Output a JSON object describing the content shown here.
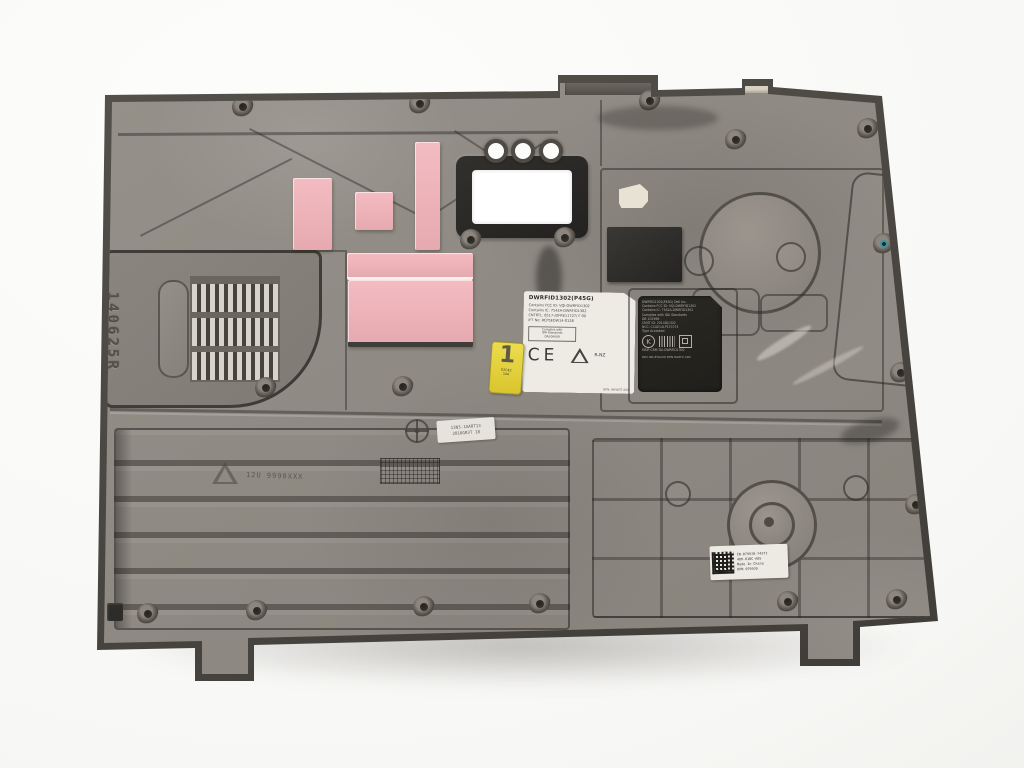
{
  "palette": {
    "background": "#fafaf9",
    "panel_face": "#8f8a83",
    "panel_rim": "#44413d",
    "vent_slat": "#d7d3ca",
    "pad_pink": "#edb3b9",
    "foam_black": "#2e2c2a",
    "gasket_black": "#282725",
    "label_white": "#edebe4",
    "etched_bg": "#26241f",
    "etched_text": "#b4afa6",
    "sticker_yellow": "#e5d13b",
    "teal_hole": "#3f93a0"
  },
  "markings": {
    "vent_serial": "140625R",
    "material_code": "12U 9990XXX",
    "mold_label": {
      "line1": "13N3-1AA0T13",
      "line2": "2016GR3T 18"
    }
  },
  "reg_label": {
    "title": "DWRFID1302(P45G)",
    "lines": [
      "Contains FCC ID: VQI-DWRFID1302",
      "Contains IC: 7542A-DWRFID1302",
      "CNTRTL: 6517-/DFRE11727/ F 00",
      "IFT No: RCP5EDW14-0128"
    ],
    "box_lines": [
      "Complies with",
      "IDA Standards",
      "DA106008"
    ],
    "ce_mark": "CE",
    "rnz_label": "R-NZ",
    "footer": "GPN: N6WGT A00"
  },
  "etched_label": {
    "lines": [
      "DWRFID1302(P45G)  Dell Inc.",
      "Contains FCC ID: VQI-DWRFID1302",
      "Contains IC: 7542A-DWRFID1302",
      "Complies with IDA Standards",
      "DB 102966",
      "CMIIT ID: 2014DJ1302",
      "NCC: CCAE14LP1370T3",
      "Type Accepted"
    ],
    "kc_mark": "K",
    "msip_line": "MSIP-CRM-TAI-DWRFID1302",
    "footer": "DPC NR-8TAC06  DPN 8A8T2 A00"
  },
  "stickers": {
    "yellow": {
      "digit": "1",
      "code1": "E2C4Z",
      "code2": "10A"
    },
    "dell": {
      "line1": "CN-0799J0-74373",
      "line2": "48H-01BC-A05",
      "line3": "Made In China",
      "line4": "DPN 0799J0"
    }
  }
}
